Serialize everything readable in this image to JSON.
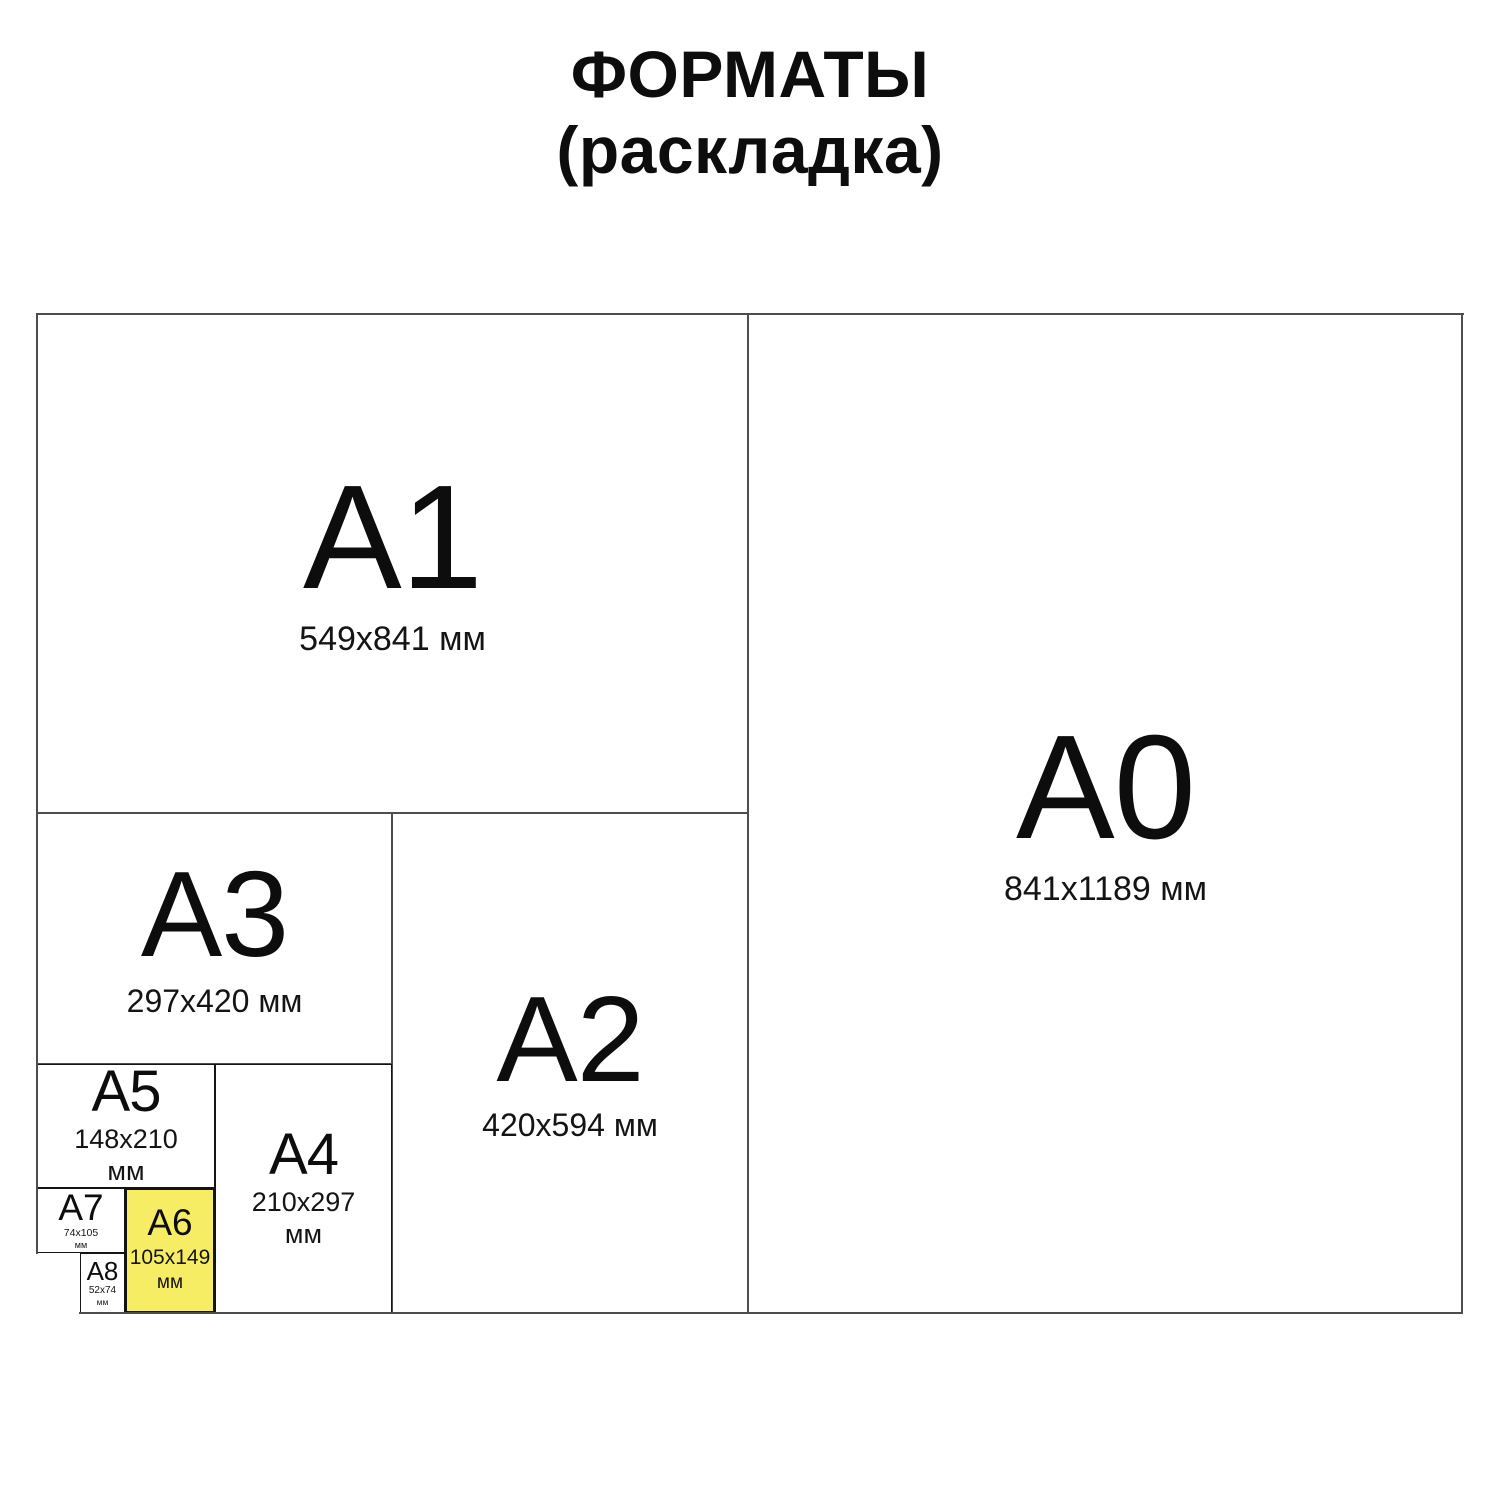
{
  "title": {
    "line1": "ФОРМАТЫ",
    "line2": "(раскладка)"
  },
  "colors": {
    "background": "#ffffff",
    "highlight_fill": "#F6ED64",
    "border_major": "#4d4d4d",
    "border_minor": "#141414",
    "text": "#111111"
  },
  "formats": {
    "a0": {
      "label": "A0",
      "dims": "841x1189 мм"
    },
    "a1": {
      "label": "A1",
      "dims": "549x841 мм"
    },
    "a2": {
      "label": "A2",
      "dims": "420x594 мм"
    },
    "a3": {
      "label": "A3",
      "dims": "297x420 мм"
    },
    "a4": {
      "label": "A4",
      "dims_value": "210x297",
      "dims_unit": "мм"
    },
    "a5": {
      "label": "A5",
      "dims_value": "148x210",
      "dims_unit": "мм"
    },
    "a6": {
      "label": "A6",
      "dims_value": "105x149",
      "dims_unit": "мм",
      "highlighted": true
    },
    "a7": {
      "label": "A7",
      "dims_value": "74x105",
      "dims_unit": "мм"
    },
    "a8": {
      "label": "A8",
      "dims_value": "52x74",
      "dims_unit": "мм"
    }
  }
}
